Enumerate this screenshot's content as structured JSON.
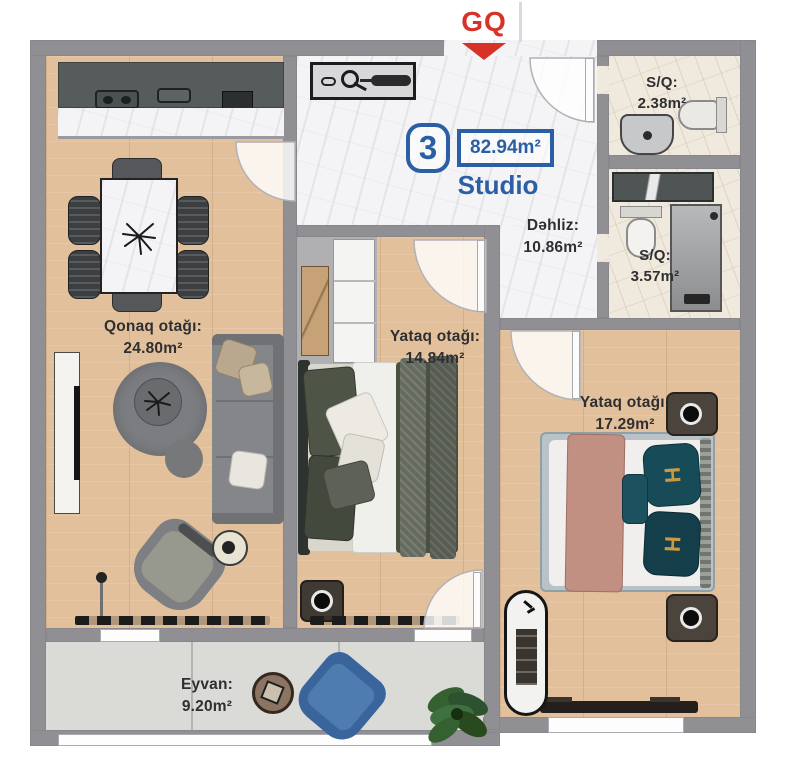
{
  "header": {
    "logo": "GQ"
  },
  "unit_badge": {
    "number": "3",
    "area": "82.94m²",
    "type": "Studio"
  },
  "rooms": {
    "hallway": {
      "name": "Dəhliz:",
      "area": "10.86m²"
    },
    "living": {
      "name": "Qonaq otağı:",
      "area": "24.80m²"
    },
    "bedroom1": {
      "name": "Yataq otağı:",
      "area": "14.84m²"
    },
    "bedroom2": {
      "name": "Yataq otağı:",
      "area": "17.29m²"
    },
    "balcony": {
      "name": "Eyvan:",
      "area": "9.20m²"
    },
    "bathroom1": {
      "name": "S/Q:",
      "area": "2.38m²"
    },
    "bathroom2": {
      "name": "S/Q:",
      "area": "3.57m²"
    }
  },
  "furniture": {
    "pillow_monogram": "H"
  },
  "colors": {
    "accent_blue": "#2b5fa5",
    "logo_red": "#d73227",
    "wall_gray": "#8f8f94",
    "wood_floor": "#e2c09c",
    "label_text": "#2f2f31"
  }
}
